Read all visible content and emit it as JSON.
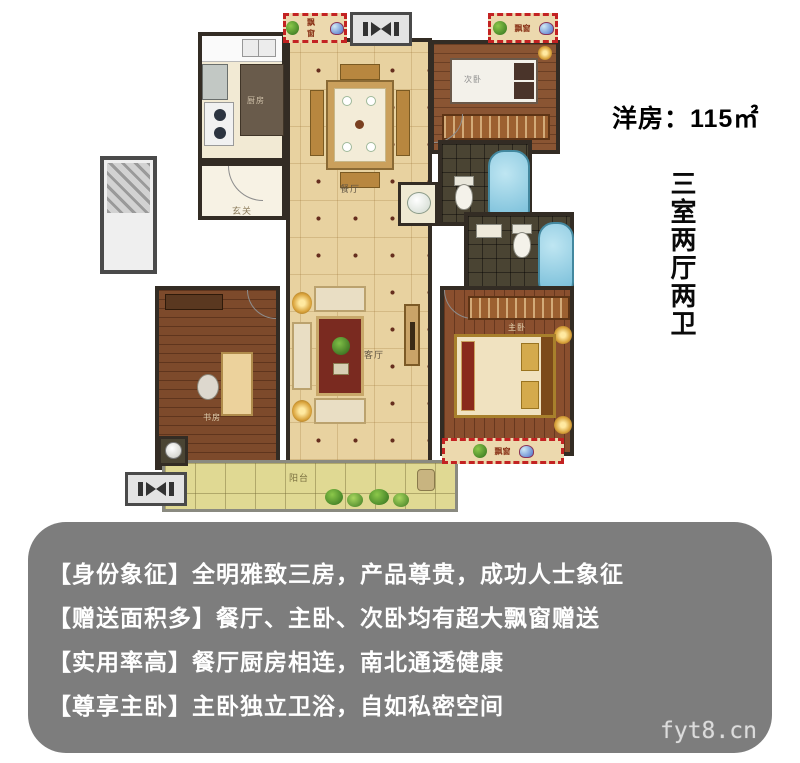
{
  "header": {
    "area_label": "洋房：115㎡",
    "layout_label": "三室两厅两卫"
  },
  "floorplan": {
    "labels": {
      "kitchen": "厨房",
      "dining": "餐厅",
      "foyer": "玄关",
      "bedroom2": "次卧",
      "living": "客厅",
      "study": "书房",
      "master": "主卧",
      "balcony": "阳台",
      "bay_window": "飘窗"
    }
  },
  "selling_points": [
    "【身份象征】全明雅致三房，产品尊贵，成功人士象征",
    "【赠送面积多】餐厅、主卧、次卧均有超大飘窗赠送",
    "【实用率高】餐厅厨房相连，南北通透健康",
    "【尊享主卧】主卧独立卫浴，自如私密空间"
  ],
  "watermark": "fyt8.cn",
  "colors": {
    "panel_gray": "#7d7d7d",
    "bay_window_red": "#c32222",
    "tile_tan": "#e8d2a0",
    "wood_brown": "#8a5533",
    "bath_tile": "#4a4433",
    "bathtub_blue": "#6fb9d6",
    "wall_dark": "#332c24",
    "balcony_tile": "#e0d993"
  }
}
